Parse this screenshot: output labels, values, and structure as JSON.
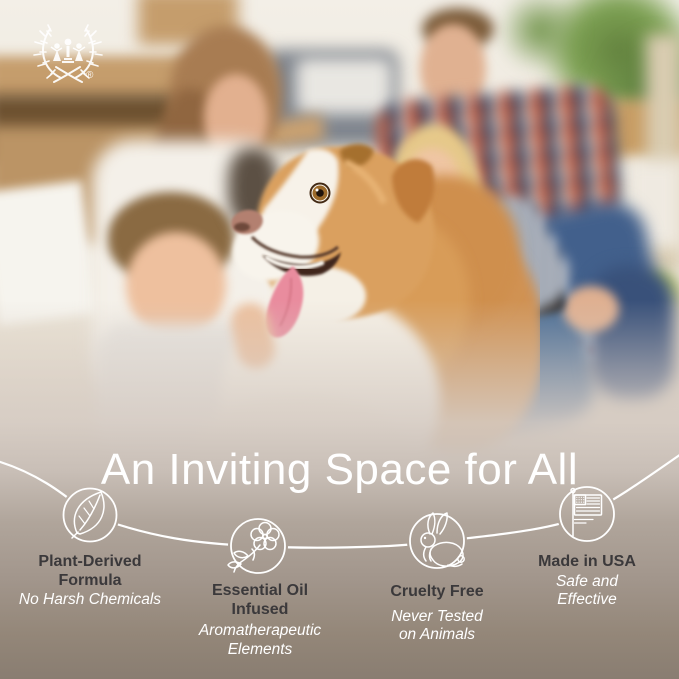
{
  "brand": {
    "logo_name": "laurel-wreath-children-emblem",
    "registered_mark": "®"
  },
  "headline": "An Inviting Space for All",
  "features": [
    {
      "icon": "leaf-icon",
      "title": [
        "Plant-Derived",
        "Formula"
      ],
      "subtitle": [
        "No Harsh Chemicals"
      ]
    },
    {
      "icon": "essential-oil-flower-icon",
      "title": [
        "Essential Oil",
        "Infused"
      ],
      "subtitle": [
        "Aromatherapeutic",
        "Elements"
      ]
    },
    {
      "icon": "rabbit-icon",
      "title": [
        "Cruelty Free"
      ],
      "subtitle": [
        "Never Tested",
        "on Animals"
      ]
    },
    {
      "icon": "usa-flag-icon",
      "title": [
        "Made in USA"
      ],
      "subtitle": [
        "Safe and",
        "Effective"
      ]
    }
  ],
  "colors": {
    "panel_top": "#c9bfb7",
    "panel_bottom": "#897d71",
    "heading_text": "#3b393b",
    "subtitle_text": "#ffffff",
    "line_and_icons": "#ffffff"
  }
}
